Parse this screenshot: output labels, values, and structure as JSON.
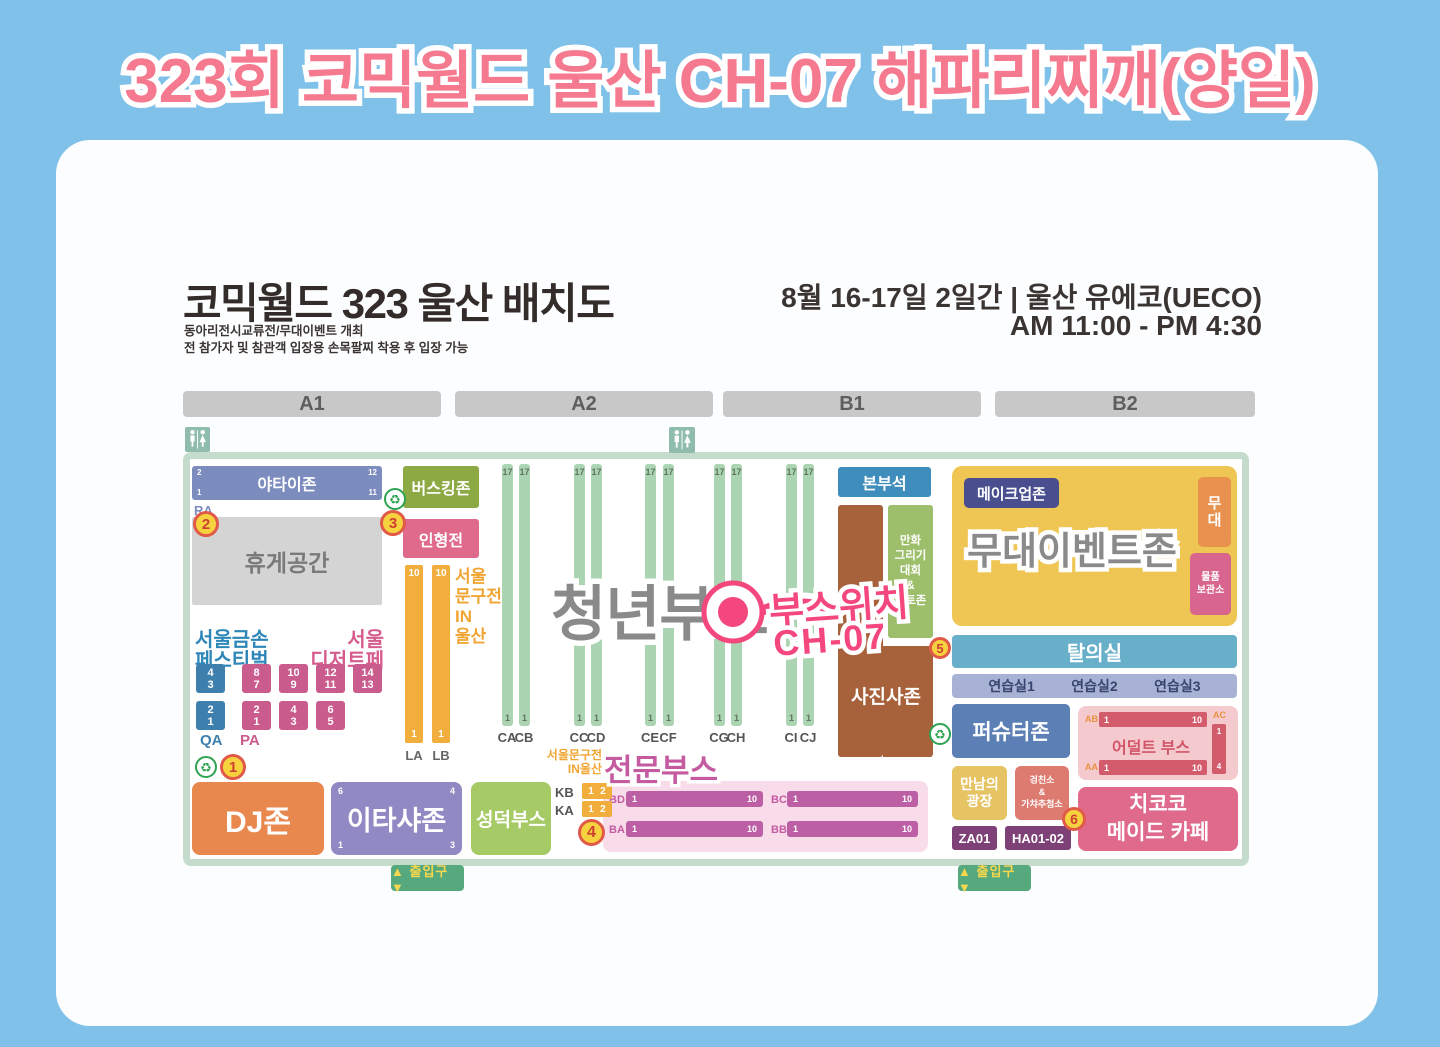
{
  "page_title": "323회 코믹월드 울산 CH-07 해파리찌깨(양일)",
  "header": {
    "map_title": "코믹월드 323 울산 배치도",
    "subtitle_1": "동아리전시교류전/무대이벤트 개최",
    "subtitle_2": "전 참가자 및 참관객 입장용 손목팔찌 착용 후 입장 가능",
    "date": "8월 16-17일 2일간 | 울산 유에코(UECO)",
    "time": "AM 11:00 - PM 4:30"
  },
  "sections": [
    "A1",
    "A2",
    "B1",
    "B2"
  ],
  "icons": {
    "recycle": "♻",
    "toilet": "restroom-figures"
  },
  "markers": {
    "m1": "1",
    "m2": "2",
    "m3": "3",
    "m4": "4",
    "m5": "5",
    "m6": "6"
  },
  "sticker": {
    "line1": "부스위치",
    "line2": "CH-07"
  },
  "zones": {
    "yatai": {
      "label": "야타이존",
      "tl": "2",
      "tr": "12",
      "bl": "1",
      "br": "11",
      "row": "RA"
    },
    "rest": "휴게공간",
    "busking": "버스킹존",
    "doll": "인형전",
    "stationery_side": "서울\n문구전\nIN\n울산",
    "gold_hands": "서울금손\n페스티벌",
    "dessert": "서울\n디저트페어",
    "qa": {
      "label": "QA",
      "boxes": [
        [
          "4",
          "3"
        ],
        [
          "2",
          "1"
        ]
      ]
    },
    "pa": {
      "label": "PA",
      "row1": [
        [
          "8",
          "7"
        ],
        [
          "10",
          "9"
        ],
        [
          "12",
          "11"
        ],
        [
          "14",
          "13"
        ]
      ],
      "row2": [
        [
          "2",
          "1"
        ],
        [
          "4",
          "3"
        ],
        [
          "6",
          "5"
        ]
      ]
    },
    "la": {
      "label": "LA",
      "top": "10",
      "bottom": "1"
    },
    "lb": {
      "label": "LB",
      "top": "10",
      "bottom": "1"
    },
    "c_rows": [
      {
        "label": "CA",
        "top": "17",
        "bottom": "1"
      },
      {
        "label": "CB",
        "top": "17",
        "bottom": "1"
      },
      {
        "label": "CC",
        "top": "17",
        "bottom": "1"
      },
      {
        "label": "CD",
        "top": "17",
        "bottom": "1"
      },
      {
        "label": "CE",
        "top": "17",
        "bottom": "1"
      },
      {
        "label": "CF",
        "top": "17",
        "bottom": "1"
      },
      {
        "label": "CG",
        "top": "17",
        "bottom": "1"
      },
      {
        "label": "CH",
        "top": "17",
        "bottom": "1"
      },
      {
        "label": "CI",
        "top": "17",
        "bottom": "1"
      },
      {
        "label": "CJ",
        "top": "17",
        "bottom": "1"
      }
    ],
    "youth": "청년부스",
    "hq": "본부석",
    "photo": "사진사존",
    "manga": "만화\n그리기\n대회\n&\n포토존",
    "stage_event": "무대이벤트존",
    "makeup": "메이크업존",
    "stage": "무\n대",
    "storage": "물품\n보관소",
    "dressing": "탈의실",
    "practice": [
      "연습실1",
      "연습실2",
      "연습실3"
    ],
    "fursuit": "퍼슈터존",
    "adult": {
      "label": "어덜트 부스",
      "ab": {
        "label": "AB",
        "start": "1",
        "end": "10"
      },
      "aa": {
        "label": "AA",
        "start": "1",
        "end": "10"
      },
      "ac": {
        "label": "AC",
        "start": "1",
        "end": "4"
      }
    },
    "meeting": "만남의\n광장",
    "gacha": "겅친소\n&\n가챠추첨소",
    "za": "ZA01",
    "ha": "HA01-02",
    "maid": "치코코\n메이드 카페",
    "dj": "DJ존",
    "itasha": {
      "label": "이타샤존",
      "tl": "6",
      "tr": "4",
      "bl": "1",
      "br": "3"
    },
    "seongdeok": "성덕부스",
    "pro": {
      "title": "전문부스",
      "stationery": "서울문구전\nIN울산",
      "kb": {
        "label": "KB",
        "n1": "1",
        "n2": "2"
      },
      "ka": {
        "label": "KA",
        "n1": "1",
        "n2": "2"
      },
      "bars": [
        {
          "label": "BD",
          "start": "1",
          "end": "10"
        },
        {
          "label": "BC",
          "start": "1",
          "end": "10"
        },
        {
          "label": "BA",
          "start": "1",
          "end": "10"
        },
        {
          "label": "BB",
          "start": "1",
          "end": "10"
        }
      ]
    },
    "exit": "▲ 출입구 ▼"
  }
}
